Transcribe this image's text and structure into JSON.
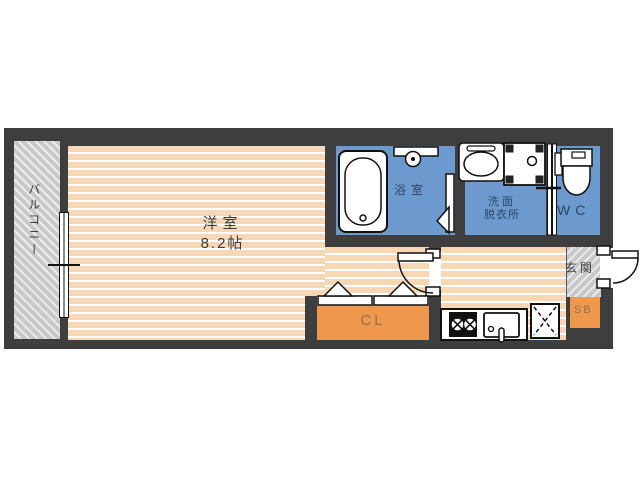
{
  "plan": {
    "balcony_label": "バルコニー",
    "main_room_name": "洋室",
    "main_room_size": "8.2帖",
    "bath_label": "浴室",
    "washroom_line1": "洗面",
    "washroom_line2": "脱衣所",
    "wc_label": "WC",
    "entrance_label": "玄関",
    "closet_label": "CL",
    "shoebox_label": "SB"
  },
  "colors": {
    "wall": "#3e3e3e",
    "room_floor": "#f8d7b4",
    "wet_area": "#6c9ace",
    "storage": "#f0974e",
    "balcony_gray": "#c8c8c8",
    "label_dark": "#3c3c3c",
    "label_navy": "#2e4666",
    "label_brown": "#96704c"
  },
  "fixtures": {
    "bathtub": "bathtub",
    "shower_shelf": "shower-shelf",
    "bath_door": "bath-folding-door",
    "wash_basin": "wash-basin",
    "washing_machine_pan": "washing-machine-pan",
    "toilet": "toilet",
    "sliding_door": "sliding-door",
    "room_door": "interior-door",
    "front_door": "front-door",
    "balcony_window": "sliding-window",
    "bifold_closet_doors": "bifold-closet-doors",
    "stove": "two-burner-stove",
    "kitchen_sink": "kitchen-sink",
    "refrigerator_space": "refrigerator-space"
  }
}
